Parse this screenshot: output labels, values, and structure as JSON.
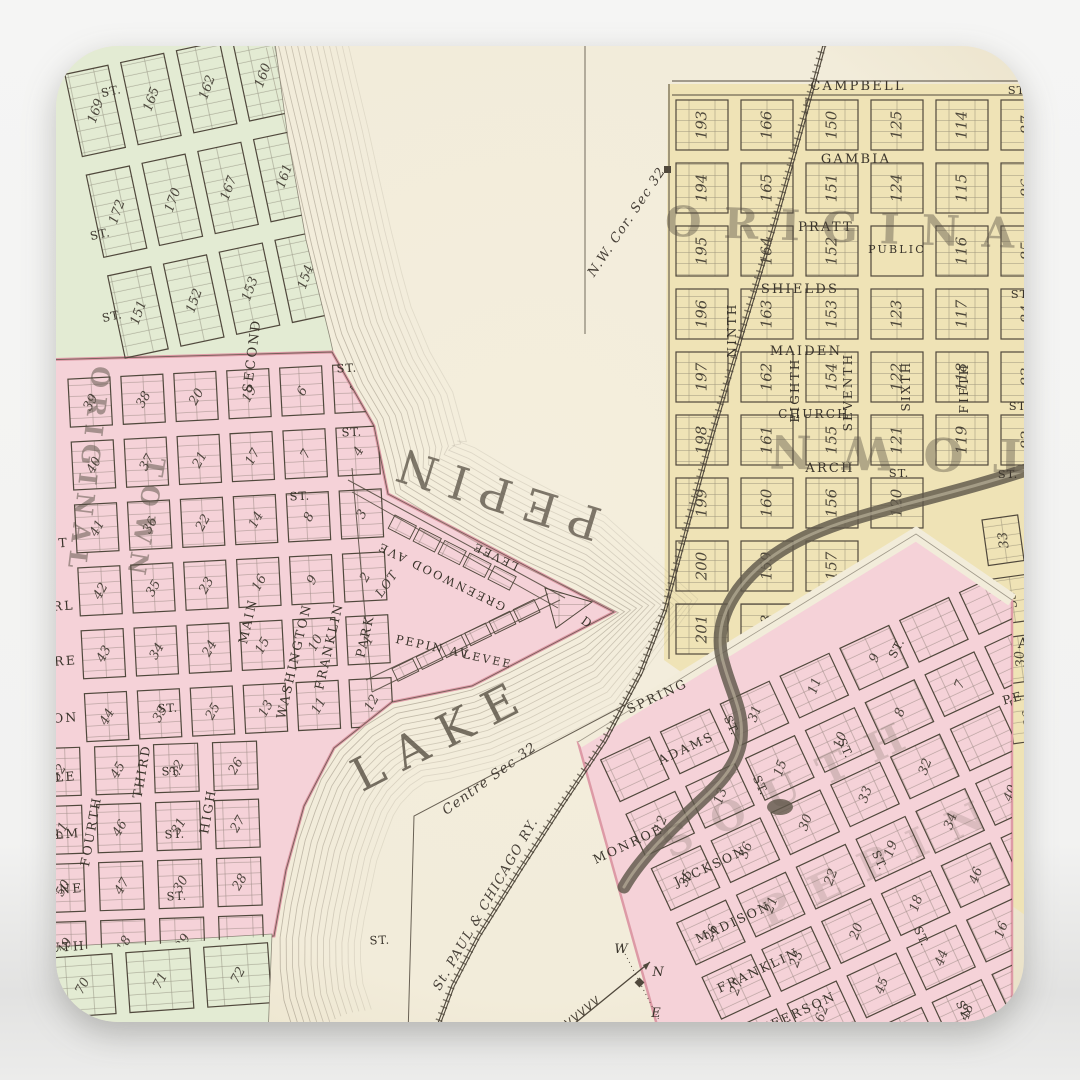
{
  "scene": {
    "background_top": "#f5f5f4",
    "background_bottom": "#e2e2e1"
  },
  "map": {
    "palette": {
      "paper": "#f2ecda",
      "paper_edge": "#e9e0c6",
      "green": "#e3ebd3",
      "pink": "#f5d2d8",
      "pink_rim": "#dd9aa6",
      "yellow": "#efe3b6",
      "ink": "#50483c",
      "label": "#3a342b",
      "contour": "#8a8070",
      "creek": "#5f584a",
      "bigtext": "#574f43"
    },
    "grids": {
      "yellow": {
        "rows": [
          [
            "193",
            "166",
            "150",
            "125",
            "114",
            "87"
          ],
          [
            "194",
            "165",
            "151",
            "124",
            "115",
            "86"
          ],
          [
            "195",
            "164",
            "152",
            "PUBLIC",
            "116",
            "85"
          ],
          [
            "196",
            "163",
            "153",
            "123",
            "117",
            "84"
          ],
          [
            "197",
            "162",
            "154",
            "122",
            "118",
            "83"
          ],
          [
            "198",
            "161",
            "155",
            "121",
            "119",
            "82"
          ],
          [
            "199",
            "160",
            "156",
            "120",
            "-",
            "-"
          ],
          [
            "200",
            "159",
            "157",
            "-",
            "-",
            "-"
          ],
          [
            "201",
            "158",
            "-",
            "-",
            "-",
            "-"
          ]
        ]
      },
      "yellow_east": {
        "rows": [
          [
            "33",
            "34"
          ],
          [
            "35",
            "32"
          ],
          [
            "30",
            "31"
          ],
          [
            "36",
            "29"
          ]
        ]
      },
      "green_nw": {
        "rows": [
          [
            "171",
            "168",
            "166",
            "164",
            "163"
          ],
          [
            "169",
            "165",
            "162",
            "160",
            "158"
          ],
          [
            "172",
            "170",
            "167",
            "161",
            "157"
          ],
          [
            "151",
            "152",
            "153",
            "154",
            "155"
          ]
        ]
      },
      "green_s": {
        "rows": [
          [
            "70",
            "71",
            "72",
            "73"
          ]
        ]
      },
      "pink_upper": {
        "rows": [
          [
            "39",
            "38",
            "20",
            "19",
            "6",
            "5"
          ],
          [
            "40",
            "37",
            "21",
            "17",
            "7",
            "4"
          ],
          [
            "41",
            "36",
            "22",
            "14",
            "8",
            "3"
          ],
          [
            "42",
            "35",
            "23",
            "16",
            "9",
            "2"
          ],
          [
            "43",
            "34",
            "24",
            "15",
            "10",
            "1"
          ],
          [
            "44",
            "33",
            "25",
            "13",
            "11",
            "12"
          ]
        ]
      },
      "pink_lower": {
        "rows": [
          [
            "52",
            "45",
            "32",
            "26"
          ],
          [
            "51",
            "46",
            "31",
            "27"
          ],
          [
            "50",
            "47",
            "30",
            "28"
          ],
          [
            "49",
            "18",
            "29",
            ""
          ]
        ]
      },
      "pink_south": {
        "rows": [
          [
            "",
            "",
            "31",
            "11",
            "9",
            "",
            ""
          ],
          [
            "12",
            "13",
            "15",
            "10",
            "8",
            "7",
            ""
          ],
          [
            "35",
            "36",
            "30",
            "33",
            "32",
            "",
            ""
          ],
          [
            "26",
            "21",
            "22",
            "19",
            "34",
            "40",
            ""
          ],
          [
            "27",
            "23",
            "20",
            "18",
            "46",
            "",
            ""
          ],
          [
            "61",
            "62",
            "45",
            "44",
            "16",
            "12",
            ""
          ],
          [
            "63",
            "64",
            "47",
            "48",
            "",
            "",
            ""
          ]
        ]
      }
    },
    "street_labels": [
      {
        "t": "CAMPBELL",
        "x": 858,
        "y": 90,
        "r": 0,
        "s": 13
      },
      {
        "t": "GAMBIA",
        "x": 856,
        "y": 163,
        "r": 0,
        "s": 13
      },
      {
        "t": "PRATT",
        "x": 826,
        "y": 231,
        "r": 0,
        "s": 13
      },
      {
        "t": "SHIELDS",
        "x": 800,
        "y": 293,
        "r": 0,
        "s": 13
      },
      {
        "t": "MAIDEN",
        "x": 806,
        "y": 355,
        "r": 0,
        "s": 13
      },
      {
        "t": "CHURCH",
        "x": 814,
        "y": 418,
        "r": 0,
        "s": 12
      },
      {
        "t": "ARCH",
        "x": 830,
        "y": 472,
        "r": 0,
        "s": 13
      },
      {
        "t": "PUBLIC",
        "x": 897,
        "y": 253,
        "r": 0,
        "s": 11
      },
      {
        "t": "NINTH",
        "x": 736,
        "y": 330,
        "r": -90,
        "s": 12
      },
      {
        "t": "EIGHTH",
        "x": 799,
        "y": 390,
        "r": -90,
        "s": 12
      },
      {
        "t": "SEVENTH",
        "x": 852,
        "y": 392,
        "r": -90,
        "s": 12
      },
      {
        "t": "SIXTH",
        "x": 910,
        "y": 386,
        "r": -90,
        "s": 12
      },
      {
        "t": "FIFTH",
        "x": 968,
        "y": 388,
        "r": -90,
        "s": 12
      },
      {
        "t": "SECOND",
        "x": 256,
        "y": 356,
        "r": -83,
        "s": 13
      },
      {
        "t": "MAIN",
        "x": 252,
        "y": 622,
        "r": -77,
        "s": 12.5
      },
      {
        "t": "WASHINGTON",
        "x": 298,
        "y": 662,
        "r": -77,
        "s": 12.5
      },
      {
        "t": "FRANKLIN",
        "x": 333,
        "y": 647,
        "r": -77,
        "s": 12.5
      },
      {
        "t": "PARK",
        "x": 369,
        "y": 637,
        "r": -77,
        "s": 12.5
      },
      {
        "t": "THIRD",
        "x": 146,
        "y": 772,
        "r": -80,
        "s": 12.5
      },
      {
        "t": "FOURTH",
        "x": 95,
        "y": 832,
        "r": -80,
        "s": 12.5
      },
      {
        "t": "HIGH",
        "x": 212,
        "y": 812,
        "r": -80,
        "s": 12.5
      },
      {
        "t": "T",
        "x": 64,
        "y": 547,
        "r": -4,
        "s": 12.5
      },
      {
        "t": "RL",
        "x": 64,
        "y": 610,
        "r": -4,
        "s": 12.5
      },
      {
        "t": "RE",
        "x": 66,
        "y": 665,
        "r": -4,
        "s": 12.5
      },
      {
        "t": "ON",
        "x": 66,
        "y": 722,
        "r": -4,
        "s": 12.5
      },
      {
        "t": "LE",
        "x": 66,
        "y": 781,
        "r": -4,
        "s": 12.5
      },
      {
        "t": "LM",
        "x": 68,
        "y": 838,
        "r": -4,
        "s": 12.5
      },
      {
        "t": "INE",
        "x": 68,
        "y": 893,
        "r": -4,
        "s": 12.5
      },
      {
        "t": "UTH",
        "x": 68,
        "y": 951,
        "r": -4,
        "s": 12.5
      },
      {
        "t": "GREENWOOD AVE",
        "x": 443,
        "y": 573,
        "r": 206,
        "s": 11.5
      },
      {
        "t": "LEVEE",
        "x": 497,
        "y": 553,
        "r": 206,
        "s": 11
      },
      {
        "t": "PEPIN AV.",
        "x": 434,
        "y": 651,
        "r": 12,
        "s": 11.5
      },
      {
        "t": "LEVEE",
        "x": 487,
        "y": 663,
        "r": 12,
        "s": 11
      },
      {
        "t": "D",
        "x": 585,
        "y": 626,
        "r": 35,
        "s": 12
      },
      {
        "t": "SPRING",
        "x": 659,
        "y": 700,
        "r": -25,
        "s": 12.5
      },
      {
        "t": "ADAMS",
        "x": 688,
        "y": 752,
        "r": -25,
        "s": 12.5
      },
      {
        "t": "MONROE",
        "x": 630,
        "y": 848,
        "r": -25,
        "s": 12.5
      },
      {
        "t": "JACKSON",
        "x": 712,
        "y": 870,
        "r": -25,
        "s": 12.5
      },
      {
        "t": "MADISON",
        "x": 735,
        "y": 926,
        "r": -25,
        "s": 12.5
      },
      {
        "t": "FRANKLIN",
        "x": 760,
        "y": 974,
        "r": -25,
        "s": 12.5
      },
      {
        "t": "JEFFERSON",
        "x": 792,
        "y": 1020,
        "r": -25,
        "s": 12.5
      },
      {
        "t": "PE",
        "x": 1014,
        "y": 702,
        "r": -15,
        "s": 12
      },
      {
        "t": "A",
        "x": 1024,
        "y": 648,
        "r": 0,
        "s": 14
      }
    ],
    "st_label_text": "ST.",
    "st_labels": [
      [
        1018,
        94,
        0
      ],
      [
        1021,
        298,
        0
      ],
      [
        1019,
        410,
        0
      ],
      [
        1008,
        478,
        0
      ],
      [
        899,
        477,
        0
      ],
      [
        112,
        95,
        -12
      ],
      [
        101,
        238,
        -12
      ],
      [
        113,
        320,
        -12
      ],
      [
        347,
        372,
        -3
      ],
      [
        352,
        436,
        -3
      ],
      [
        300,
        500,
        -3
      ],
      [
        168,
        712,
        -3
      ],
      [
        172,
        775,
        -3
      ],
      [
        175,
        838,
        -3
      ],
      [
        177,
        900,
        -3
      ],
      [
        380,
        944,
        -3
      ],
      [
        757,
        787,
        65
      ],
      [
        842,
        750,
        65
      ],
      [
        876,
        862,
        65
      ],
      [
        918,
        938,
        65
      ],
      [
        728,
        727,
        65
      ],
      [
        900,
        650,
        -62
      ],
      [
        960,
        1012,
        65
      ]
    ],
    "big_labels": [
      {
        "t": "PEPIN",
        "x": 497,
        "y": 477,
        "r": 197,
        "s": 46,
        "ls": 14,
        "o": 0.75,
        "w": "normal"
      },
      {
        "t": "LAKE",
        "x": 449,
        "y": 748,
        "r": -27,
        "s": 46,
        "ls": 16,
        "o": 0.8,
        "w": "normal"
      },
      {
        "t": "ORIGINAL",
        "x": 876,
        "y": 243,
        "r": 2,
        "s": 42,
        "ls": 22,
        "o": 0.42,
        "w": "bold"
      },
      {
        "t": "TOWN",
        "x": 884,
        "y": 437,
        "r": 181,
        "s": 46,
        "ls": 30,
        "o": 0.4,
        "w": "bold"
      },
      {
        "t": "ORIGINAL",
        "x": 80,
        "y": 470,
        "r": 97,
        "s": 25,
        "ls": 8,
        "o": 0.5,
        "w": "bold"
      },
      {
        "t": "TOWN",
        "x": 137,
        "y": 519,
        "r": 100,
        "s": 25,
        "ls": 9,
        "o": 0.5,
        "w": "bold"
      },
      {
        "t": "SOUTH",
        "x": 800,
        "y": 798,
        "r": -25,
        "s": 40,
        "ls": 24,
        "o": 0.2,
        "w": "bold"
      },
      {
        "t": "PEPIN",
        "x": 888,
        "y": 872,
        "r": -25,
        "s": 40,
        "ls": 24,
        "o": 0.16,
        "w": "bold"
      }
    ],
    "annotations": [
      {
        "t": "N.W. Cor. Sec 32",
        "x": 630,
        "y": 224,
        "r": -56,
        "s": 13
      },
      {
        "t": "Centre Sec 32",
        "x": 492,
        "y": 782,
        "r": -36,
        "s": 13.5
      },
      {
        "t": "St. PAUL & CHICAGO RY.",
        "x": 489,
        "y": 906,
        "r": -60,
        "s": 13
      },
      {
        "t": "LOT",
        "x": 390,
        "y": 586,
        "r": -55,
        "s": 12
      }
    ],
    "compass": {
      "letters": [
        {
          "t": "W",
          "x": 621,
          "y": 953
        },
        {
          "t": "N",
          "x": 658,
          "y": 976
        },
        {
          "t": "E",
          "x": 656,
          "y": 1017
        }
      ]
    }
  }
}
